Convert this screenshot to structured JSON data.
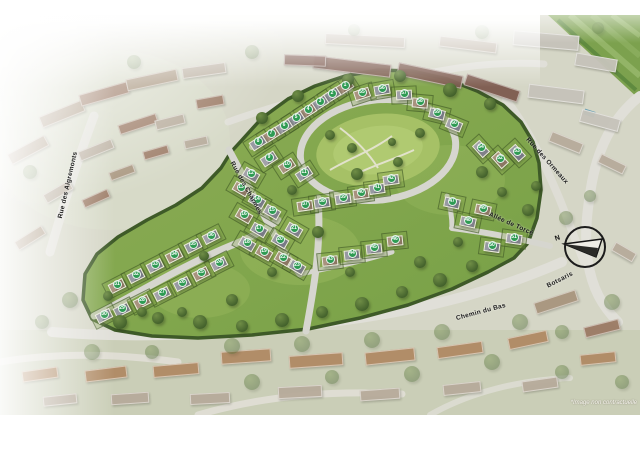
{
  "disclaimer": "*Image non contractuelle",
  "compass": {
    "north_label": "N"
  },
  "colors": {
    "page_background": "#ffffff",
    "aerial_base": "#d5d6c6",
    "estate_grass": "#82a74d",
    "park_green": "#a6c166",
    "hedge_green": "#3e5a28",
    "road_gray": "#dedcd4",
    "lot_badge_green": "#2e9b53",
    "lot_badge_text": "#ffffff",
    "label_text": "#1c1c1c",
    "field_green": "#7ca14e",
    "pool_blue": "#6fa3b5",
    "terrace_roof": "#7d5a4e"
  },
  "street_labels": [
    {
      "text": "Rue des Aigremonts",
      "x": 68,
      "y": 185,
      "rot": -77
    },
    {
      "text": "Rue des Charmes",
      "x": 246,
      "y": 188,
      "rot": 61
    },
    {
      "text": "Rue des Ormeaux",
      "x": 547,
      "y": 161,
      "rot": 48
    },
    {
      "text": "Allée de Torcé",
      "x": 511,
      "y": 224,
      "rot": 24
    },
    {
      "text": "Chemin du Bas",
      "x": 481,
      "y": 312,
      "rot": -15
    },
    {
      "text": "Botsaris",
      "x": 560,
      "y": 280,
      "rot": -27
    }
  ],
  "lots": [
    [
      1,
      345,
      85,
      -33
    ],
    [
      2,
      332,
      93,
      -33
    ],
    [
      3,
      320,
      101,
      -33
    ],
    [
      4,
      308,
      109,
      -33
    ],
    [
      5,
      296,
      117,
      -33
    ],
    [
      6,
      284,
      125,
      -33
    ],
    [
      7,
      271,
      133,
      -33
    ],
    [
      8,
      258,
      141,
      -33
    ],
    [
      9,
      269,
      157,
      -33
    ],
    [
      10,
      287,
      164,
      -33
    ],
    [
      11,
      304,
      172,
      -33
    ],
    [
      12,
      251,
      173,
      30
    ],
    [
      13,
      241,
      187,
      30
    ],
    [
      14,
      257,
      199,
      30
    ],
    [
      15,
      272,
      210,
      30
    ],
    [
      16,
      244,
      214,
      30
    ],
    [
      17,
      259,
      228,
      30
    ],
    [
      18,
      247,
      242,
      30
    ],
    [
      19,
      264,
      251,
      30
    ],
    [
      20,
      280,
      239,
      30
    ],
    [
      21,
      294,
      228,
      30
    ],
    [
      22,
      283,
      257,
      30
    ],
    [
      23,
      297,
      265,
      30
    ],
    [
      24,
      219,
      262,
      -27
    ],
    [
      25,
      201,
      272,
      -27
    ],
    [
      26,
      182,
      282,
      -27
    ],
    [
      27,
      162,
      292,
      -27
    ],
    [
      28,
      142,
      300,
      -27
    ],
    [
      29,
      122,
      308,
      -27
    ],
    [
      30,
      104,
      314,
      -27
    ],
    [
      31,
      117,
      284,
      -27
    ],
    [
      32,
      136,
      274,
      -27
    ],
    [
      33,
      155,
      264,
      -27
    ],
    [
      34,
      174,
      254,
      -27
    ],
    [
      35,
      193,
      244,
      -27
    ],
    [
      36,
      211,
      235,
      -27
    ],
    [
      37,
      305,
      204,
      -8
    ],
    [
      38,
      322,
      201,
      -8
    ],
    [
      39,
      343,
      197,
      -8
    ],
    [
      40,
      361,
      192,
      -8
    ],
    [
      41,
      377,
      187,
      -8
    ],
    [
      42,
      391,
      178,
      -8
    ],
    [
      43,
      330,
      259,
      -6
    ],
    [
      44,
      352,
      253,
      -6
    ],
    [
      45,
      374,
      247,
      -6
    ],
    [
      46,
      395,
      239,
      -6
    ],
    [
      47,
      452,
      201,
      12
    ],
    [
      48,
      468,
      220,
      12
    ],
    [
      49,
      483,
      208,
      12
    ],
    [
      50,
      492,
      245,
      8
    ],
    [
      51,
      514,
      237,
      8
    ],
    [
      52,
      500,
      158,
      48
    ],
    [
      53,
      517,
      151,
      48
    ],
    [
      54,
      481,
      147,
      48
    ],
    [
      55,
      362,
      92,
      -18
    ],
    [
      56,
      382,
      88,
      -10
    ],
    [
      57,
      404,
      93,
      -3
    ],
    [
      58,
      420,
      101,
      5
    ],
    [
      59,
      437,
      112,
      14
    ],
    [
      60,
      454,
      123,
      22
    ]
  ],
  "buildings": [
    [
      352,
      66,
      78,
      13,
      7,
      4
    ],
    [
      430,
      75,
      66,
      13,
      12,
      4
    ],
    [
      492,
      88,
      56,
      12,
      18,
      4
    ],
    [
      305,
      60,
      42,
      11,
      2,
      4
    ],
    [
      365,
      40,
      80,
      11,
      3,
      2
    ],
    [
      468,
      44,
      58,
      11,
      7,
      2
    ],
    [
      546,
      40,
      66,
      15,
      5,
      5
    ],
    [
      596,
      62,
      42,
      13,
      10,
      5
    ],
    [
      556,
      94,
      56,
      14,
      7,
      5
    ],
    [
      600,
      120,
      40,
      13,
      15,
      5
    ],
    [
      566,
      142,
      34,
      11,
      22,
      2
    ],
    [
      612,
      164,
      28,
      10,
      26,
      2
    ],
    [
      28,
      150,
      42,
      12,
      -28,
      1
    ],
    [
      62,
      114,
      46,
      12,
      -22,
      1
    ],
    [
      104,
      94,
      50,
      12,
      -16,
      0
    ],
    [
      152,
      80,
      52,
      12,
      -12,
      1
    ],
    [
      204,
      70,
      44,
      11,
      -8,
      2
    ],
    [
      96,
      150,
      36,
      10,
      -22,
      2
    ],
    [
      138,
      124,
      40,
      10,
      -18,
      0
    ],
    [
      58,
      192,
      30,
      10,
      -30,
      2
    ],
    [
      30,
      238,
      32,
      10,
      -32,
      1
    ],
    [
      96,
      198,
      28,
      9,
      -24,
      0
    ],
    [
      170,
      122,
      30,
      10,
      -14,
      2
    ],
    [
      210,
      102,
      28,
      10,
      -10,
      0
    ],
    [
      122,
      172,
      26,
      9,
      -20,
      1
    ],
    [
      156,
      152,
      26,
      9,
      -16,
      0
    ],
    [
      196,
      142,
      24,
      9,
      -12,
      2
    ],
    [
      556,
      302,
      44,
      12,
      -18,
      1
    ],
    [
      602,
      328,
      36,
      11,
      -14,
      0
    ],
    [
      624,
      252,
      24,
      10,
      30,
      2
    ],
    [
      246,
      356,
      50,
      13,
      -4,
      3
    ],
    [
      316,
      360,
      54,
      13,
      -4,
      3
    ],
    [
      390,
      356,
      50,
      13,
      -6,
      3
    ],
    [
      460,
      350,
      46,
      12,
      -8,
      3
    ],
    [
      176,
      370,
      46,
      12,
      -5,
      3
    ],
    [
      106,
      374,
      42,
      12,
      -7,
      3
    ],
    [
      40,
      374,
      36,
      11,
      -8,
      3
    ],
    [
      528,
      340,
      40,
      12,
      -12,
      3
    ],
    [
      598,
      358,
      36,
      11,
      -6,
      3
    ],
    [
      300,
      392,
      44,
      12,
      -3,
      2
    ],
    [
      380,
      394,
      40,
      11,
      -4,
      2
    ],
    [
      210,
      398,
      40,
      11,
      -3,
      2
    ],
    [
      462,
      388,
      38,
      11,
      -6,
      2
    ],
    [
      540,
      384,
      36,
      11,
      -8,
      2
    ],
    [
      130,
      398,
      38,
      11,
      -4,
      2
    ],
    [
      60,
      400,
      34,
      10,
      -6,
      2
    ]
  ],
  "building_palette": [
    "#9b7a64",
    "#a8957e",
    "#b7ab9b",
    "#b08a64",
    "#7d5a4e",
    "#c6c3ba"
  ],
  "trees": [
    [
      120,
      322,
      7,
      0
    ],
    [
      158,
      318,
      6,
      0
    ],
    [
      200,
      322,
      7,
      0
    ],
    [
      242,
      326,
      6,
      0
    ],
    [
      282,
      320,
      7,
      0
    ],
    [
      322,
      312,
      6,
      0
    ],
    [
      362,
      304,
      7,
      0
    ],
    [
      402,
      292,
      6,
      0
    ],
    [
      440,
      280,
      7,
      0
    ],
    [
      472,
      266,
      6,
      0
    ],
    [
      262,
      118,
      6,
      0
    ],
    [
      298,
      96,
      6,
      0
    ],
    [
      348,
      80,
      6,
      0
    ],
    [
      400,
      76,
      6,
      0
    ],
    [
      450,
      90,
      7,
      0
    ],
    [
      490,
      104,
      6,
      0
    ],
    [
      330,
      135,
      5,
      0
    ],
    [
      420,
      133,
      5,
      0
    ],
    [
      357,
      174,
      6,
      0
    ],
    [
      398,
      162,
      5,
      0
    ],
    [
      292,
      190,
      5,
      0
    ],
    [
      318,
      232,
      6,
      0
    ],
    [
      272,
      272,
      5,
      0
    ],
    [
      350,
      272,
      5,
      0
    ],
    [
      420,
      262,
      6,
      0
    ],
    [
      458,
      242,
      5,
      0
    ],
    [
      232,
      300,
      6,
      0
    ],
    [
      182,
      312,
      5,
      0
    ],
    [
      142,
      312,
      5,
      0
    ],
    [
      108,
      296,
      5,
      0
    ],
    [
      204,
      256,
      5,
      0
    ],
    [
      482,
      172,
      6,
      0
    ],
    [
      502,
      192,
      5,
      0
    ],
    [
      528,
      210,
      6,
      0
    ],
    [
      536,
      186,
      5,
      0
    ],
    [
      352,
      148,
      5,
      0
    ],
    [
      392,
      142,
      4,
      0
    ],
    [
      70,
      300,
      8,
      1
    ],
    [
      42,
      322,
      7,
      1
    ],
    [
      232,
      346,
      8,
      1
    ],
    [
      302,
      344,
      8,
      1
    ],
    [
      372,
      340,
      8,
      1
    ],
    [
      442,
      332,
      8,
      1
    ],
    [
      520,
      322,
      8,
      1
    ],
    [
      562,
      332,
      7,
      1
    ],
    [
      612,
      302,
      8,
      1
    ],
    [
      92,
      352,
      8,
      1
    ],
    [
      152,
      352,
      7,
      1
    ],
    [
      492,
      362,
      8,
      1
    ],
    [
      562,
      372,
      7,
      1
    ],
    [
      622,
      382,
      7,
      1
    ],
    [
      252,
      382,
      8,
      1
    ],
    [
      332,
      377,
      7,
      1
    ],
    [
      412,
      374,
      8,
      1
    ],
    [
      30,
      172,
      7,
      1
    ],
    [
      134,
      62,
      7,
      1
    ],
    [
      252,
      52,
      7,
      1
    ],
    [
      482,
      32,
      7,
      1
    ],
    [
      354,
      30,
      6,
      1
    ],
    [
      598,
      28,
      6,
      1
    ],
    [
      566,
      218,
      7,
      1
    ],
    [
      590,
      196,
      6,
      1
    ]
  ]
}
